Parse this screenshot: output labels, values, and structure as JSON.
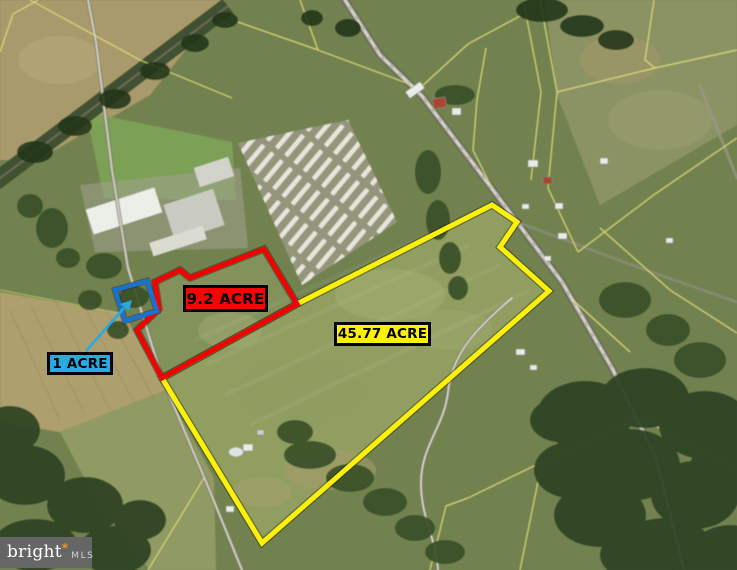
{
  "watermark": {
    "brand": "bright",
    "mark": "*",
    "suffix": "MLS",
    "bg_color": "#666666",
    "brand_color": "#ffffff",
    "accent_color": "#f7941d",
    "suffix_color": "#d6d6d6"
  },
  "parcels": [
    {
      "id": "45.77-acre",
      "acres": 45.77,
      "label": "45.77 ACRE",
      "outline_color": "#fff200",
      "label_bg": "#fff200",
      "label_text_color": "#000000"
    },
    {
      "id": "9.2-acre",
      "acres": 9.2,
      "label": "9.2 ACRE",
      "outline_color": "#f40000",
      "label_bg": "#f90404",
      "label_text_color": "#000000"
    },
    {
      "id": "1-acre",
      "acres": 1,
      "label": "1 ACRE",
      "outline_color": "#1a72d0",
      "label_bg": "#29a9e1",
      "label_text_color": "#000000",
      "arrow_color": "#2aa9e0"
    }
  ]
}
